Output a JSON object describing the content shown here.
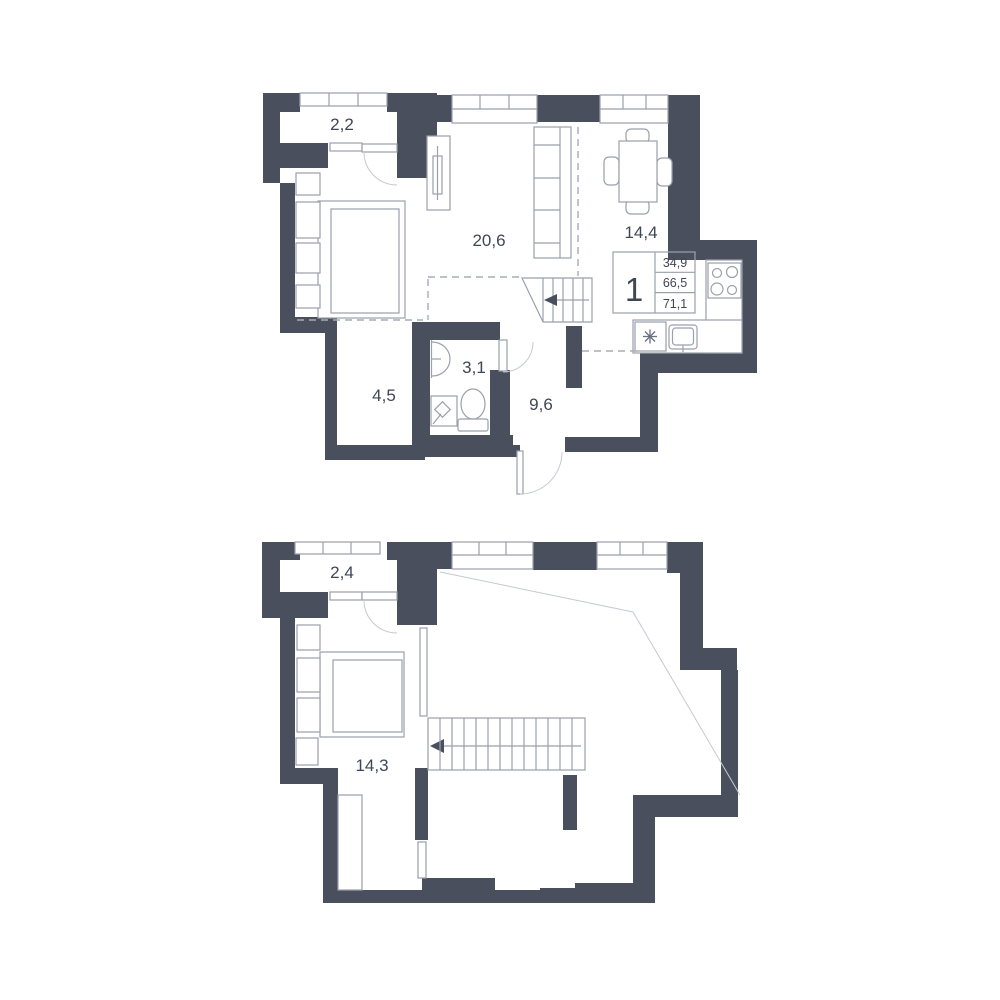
{
  "page": {
    "background": "#ffffff"
  },
  "colors": {
    "wall": "#4a4f5d",
    "furniture_line": "#9aa1ab",
    "text": "#3f4654",
    "void_line": "#c5cad1"
  },
  "level1": {
    "labels": {
      "balcony": "2,2",
      "living": "20,6",
      "dining": "14,4",
      "hall": "4,5",
      "bathroom": "3,1",
      "entry": "9,6"
    },
    "info_box": {
      "rooms": "1",
      "row1": "34,9",
      "row2": "66,5",
      "row3": "71,1"
    }
  },
  "level2": {
    "labels": {
      "balcony": "2,4",
      "room": "14,3"
    }
  },
  "icons": {
    "appliance_asterisk": "✳",
    "stair_direction_arrow": "◀"
  }
}
